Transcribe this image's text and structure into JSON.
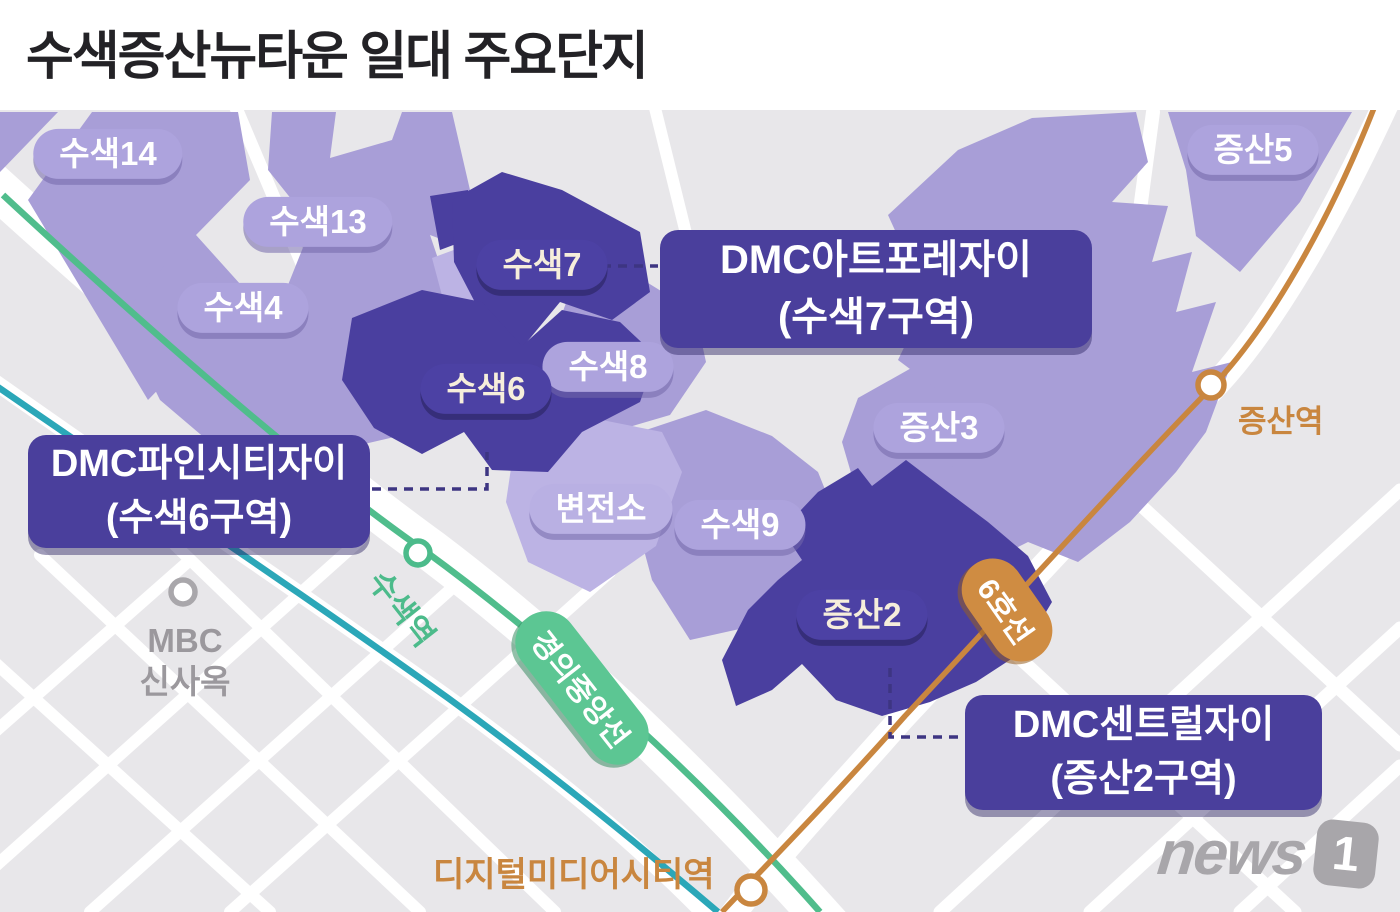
{
  "title": "수색증산뉴타운 일대 주요단지",
  "map": {
    "districts": {
      "suseok14": {
        "label": "수색14"
      },
      "suseok13": {
        "label": "수색13"
      },
      "suseok4": {
        "label": "수색4"
      },
      "suseok7": {
        "label": "수색7"
      },
      "suseok6": {
        "label": "수색6"
      },
      "suseok8": {
        "label": "수색8"
      },
      "suseok9": {
        "label": "수색9"
      },
      "byeonjeonso": {
        "label": "변전소"
      },
      "jeungsan2": {
        "label": "증산2"
      },
      "jeungsan3": {
        "label": "증산3"
      },
      "jeungsan5": {
        "label": "증산5"
      }
    },
    "callouts": {
      "artforest": {
        "line1": "DMC아트포레자이",
        "line2": "(수색7구역)"
      },
      "finecity": {
        "line1": "DMC파인시티자이",
        "line2": "(수색6구역)"
      },
      "central": {
        "line1": "DMC센트럴자이",
        "line2": "(증산2구역)"
      }
    },
    "transit": {
      "lines": {
        "gyeongui_jungang": {
          "label": "경의중앙선",
          "color": "#5cc693"
        },
        "line6": {
          "label": "6호선",
          "color": "#cf8c42"
        },
        "unnamed_teal": {
          "label": "",
          "color": "#2ba7b8"
        }
      },
      "stations": {
        "susaek": {
          "label": "수색역"
        },
        "jeungsan": {
          "label": "증산역"
        },
        "digital_media_city": {
          "label": "디지털미디어시티역"
        }
      }
    },
    "landmarks": {
      "mbc": {
        "line1": "MBC",
        "line2": "신사옥"
      }
    },
    "colors": {
      "map_bg": "#e8e7ea",
      "street": "#ffffff",
      "district_light": "#a89ed7",
      "district_lighter": "#bcb3e4",
      "district_dark": "#4a3f9f",
      "callout_bg": "#4a3f9c",
      "connector": "#3d3582"
    }
  },
  "logo": {
    "news": "news",
    "one": "1"
  }
}
